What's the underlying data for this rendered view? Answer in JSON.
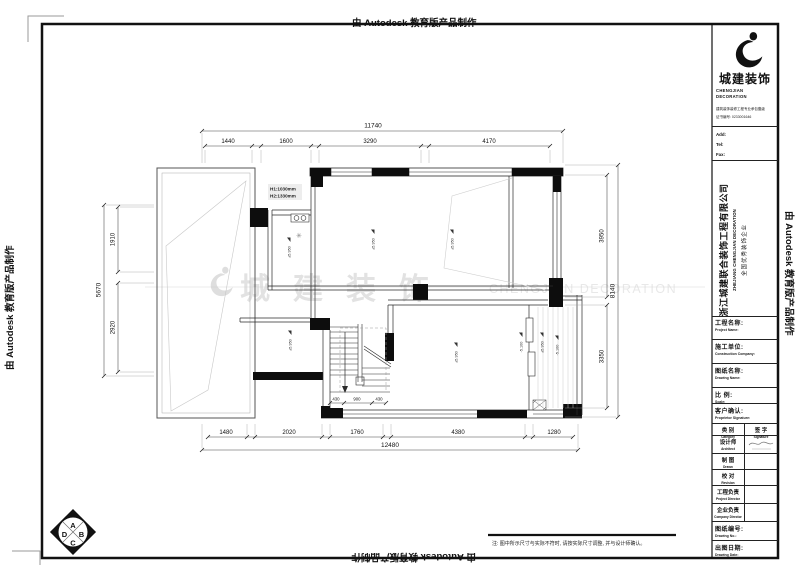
{
  "watermark": {
    "autodesk": "由 Autodesk 教育版产品制作"
  },
  "center_watermark": {
    "cn": "城建装饰",
    "en": "CHENGJIAN DECORATION"
  },
  "note": "注: 图中所示尺寸与实际不符时, 请按实际尺寸调整, 并与设计师确认。",
  "plan": {
    "dims": {
      "top_total": "11740",
      "top": [
        "1440",
        "1600",
        "3290",
        "4170"
      ],
      "bottom": [
        "1480",
        "2020",
        "1760",
        "4380",
        "1280"
      ],
      "bottom_total": "12480",
      "left": [
        "1910",
        "2920"
      ],
      "left_total": "5670",
      "right": [
        "3950",
        "3350"
      ],
      "right_total": "8140",
      "stair": [
        "430",
        "900",
        "430"
      ]
    },
    "labels": {
      "h1": "H1:1030mm",
      "h2": "H2:1330mm"
    },
    "elevations": [
      "±5.950",
      "±5.950",
      "±5.950",
      "±5.950",
      "±5.950",
      "-5.100",
      "±5.950",
      "-5.100"
    ],
    "symbols": {
      "plant": "✳"
    },
    "compass": [
      "A",
      "B",
      "C",
      "D"
    ]
  },
  "titleblock": {
    "brand": {
      "name": "城建装饰",
      "en1": "CHENGJIAN",
      "en2": "DECORATION",
      "cert1": "建筑装饰装修工程专业承包壹级",
      "cert2": "证书编号: 0233001646"
    },
    "contact": {
      "add": "Add:",
      "tel": "Tel:",
      "fax": "Fax:"
    },
    "company": {
      "cn": "浙江城建联合装饰工程有限公司",
      "en": "ZHEJIANG CHENGJIAN DECORATION",
      "honor": "全国优秀装饰企业"
    },
    "fields": [
      {
        "cn": "工程名称:",
        "en": "Project Name:"
      },
      {
        "cn": "施工单位:",
        "en": "Construction Company:"
      },
      {
        "cn": "图纸名称:",
        "en": "Drawing Name:"
      },
      {
        "cn": "比 例:",
        "en": "Scale:"
      },
      {
        "cn": "客户确认:",
        "en": "Proprietor Signature:"
      }
    ],
    "table": {
      "col1": {
        "cn": "类 别",
        "en": "Category"
      },
      "col2": {
        "cn": "签 字",
        "en": "Signature"
      },
      "rows": [
        {
          "cn": "设计师",
          "en": "Architect"
        },
        {
          "cn": "制 图",
          "en": "Drawn"
        },
        {
          "cn": "校 对",
          "en": "Revision"
        },
        {
          "cn": "工程负责",
          "en": "Project Director"
        },
        {
          "cn": "企业负责",
          "en": "Company Director"
        }
      ]
    },
    "drawing_no": {
      "cn": "图纸编号:",
      "en": "Drawing No.:"
    },
    "drawing_date": {
      "cn": "出图日期:",
      "en": "Drawing Date:"
    }
  }
}
